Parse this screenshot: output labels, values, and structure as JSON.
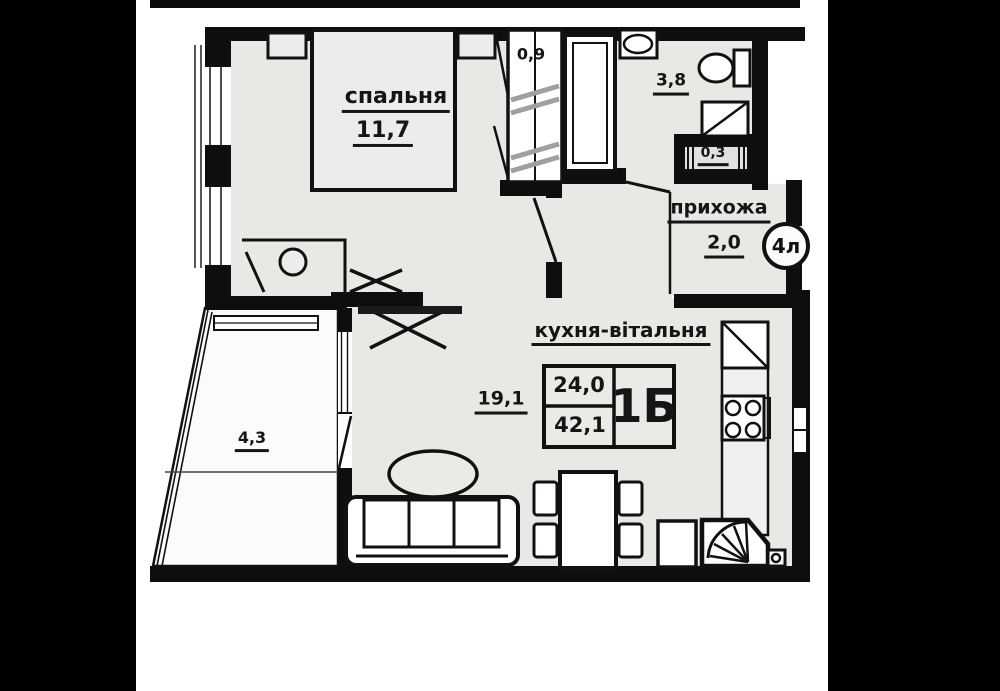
{
  "floorplan": {
    "rooms": {
      "bedroom": {
        "name": "спальня",
        "area": "11,7"
      },
      "wardrobe": {
        "area": "0,9"
      },
      "bathroom": {
        "area": "3,8"
      },
      "duct": {
        "area": "0,3"
      },
      "hallway": {
        "name": "прихожа",
        "area": "2,0"
      },
      "kitchen_living": {
        "name": "кухня-вітальня",
        "area": "19,1"
      },
      "balcony": {
        "area": "4,3"
      }
    },
    "stamp": {
      "area_living": "24,0",
      "area_total": "42,1",
      "layout_code": "1Б"
    },
    "unit_badge": "4л",
    "colors": {
      "wall": "#0e0e0e",
      "floor": "#e9e8e4",
      "balcony_floor": "#fbfbfa",
      "letterbox": "#000000",
      "hatch": "#a0a0a0"
    }
  }
}
